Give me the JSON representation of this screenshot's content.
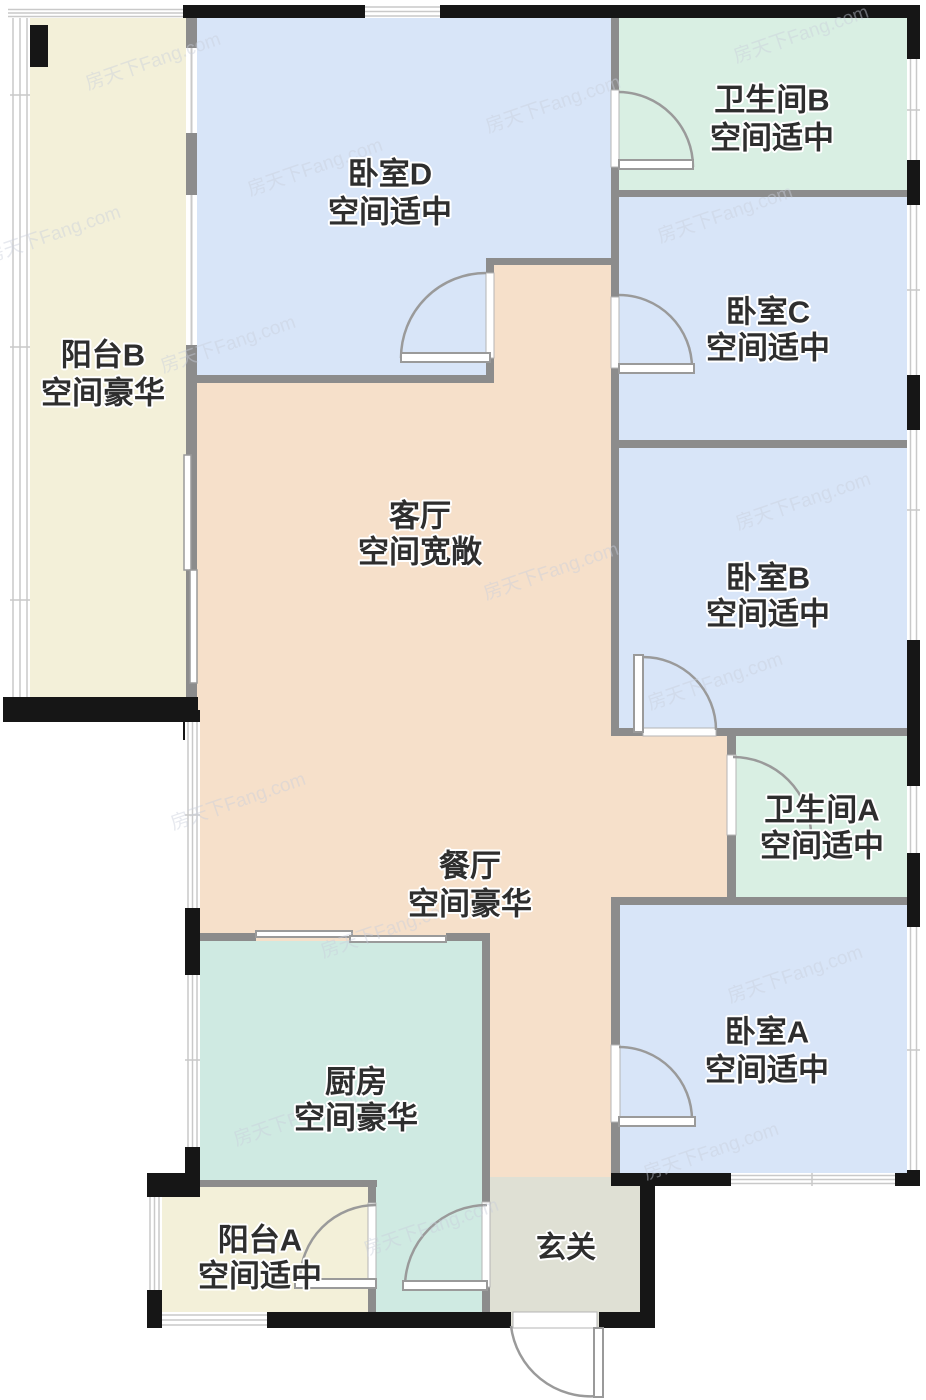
{
  "title": "户型图",
  "watermark": {
    "text": "房天下Fang.com"
  },
  "palette": {
    "wall_black": "#161616",
    "wall_gray": "#8c8c8c",
    "door_line": "#9a9a9a",
    "window_line": "#c9c9c9",
    "label_color": "#2e2e2e",
    "watermark_color": "#c9cfdb",
    "background": "#ffffff"
  },
  "rooms": [
    {
      "id": "balcony-b",
      "name": "阳台B",
      "grade": "空间豪华",
      "color": "#f3f0d9"
    },
    {
      "id": "bedroom-d",
      "name": "卧室D",
      "grade": "空间适中",
      "color": "#d8e5f8"
    },
    {
      "id": "bath-b",
      "name": "卫生间B",
      "grade": "空间适中",
      "color": "#d9efe3"
    },
    {
      "id": "bedroom-c",
      "name": "卧室C",
      "grade": "空间适中",
      "color": "#d8e5f8"
    },
    {
      "id": "bedroom-b",
      "name": "卧室B",
      "grade": "空间适中",
      "color": "#d8e5f8"
    },
    {
      "id": "bath-a",
      "name": "卫生间A",
      "grade": "空间适中",
      "color": "#d9efe3"
    },
    {
      "id": "bedroom-a",
      "name": "卧室A",
      "grade": "空间适中",
      "color": "#d8e5f8"
    },
    {
      "id": "living",
      "name": "客厅",
      "grade": "空间宽敞",
      "color": "#f6e0ca"
    },
    {
      "id": "dining",
      "name": "餐厅",
      "grade": "空间豪华",
      "color": "#f6e0ca"
    },
    {
      "id": "kitchen",
      "name": "厨房",
      "grade": "空间豪华",
      "color": "#cfeae2"
    },
    {
      "id": "balcony-a",
      "name": "阳台A",
      "grade": "空间适中",
      "color": "#f3f0d9"
    },
    {
      "id": "foyer",
      "name": "玄关",
      "grade": "",
      "color": "#dfe0d4"
    }
  ]
}
